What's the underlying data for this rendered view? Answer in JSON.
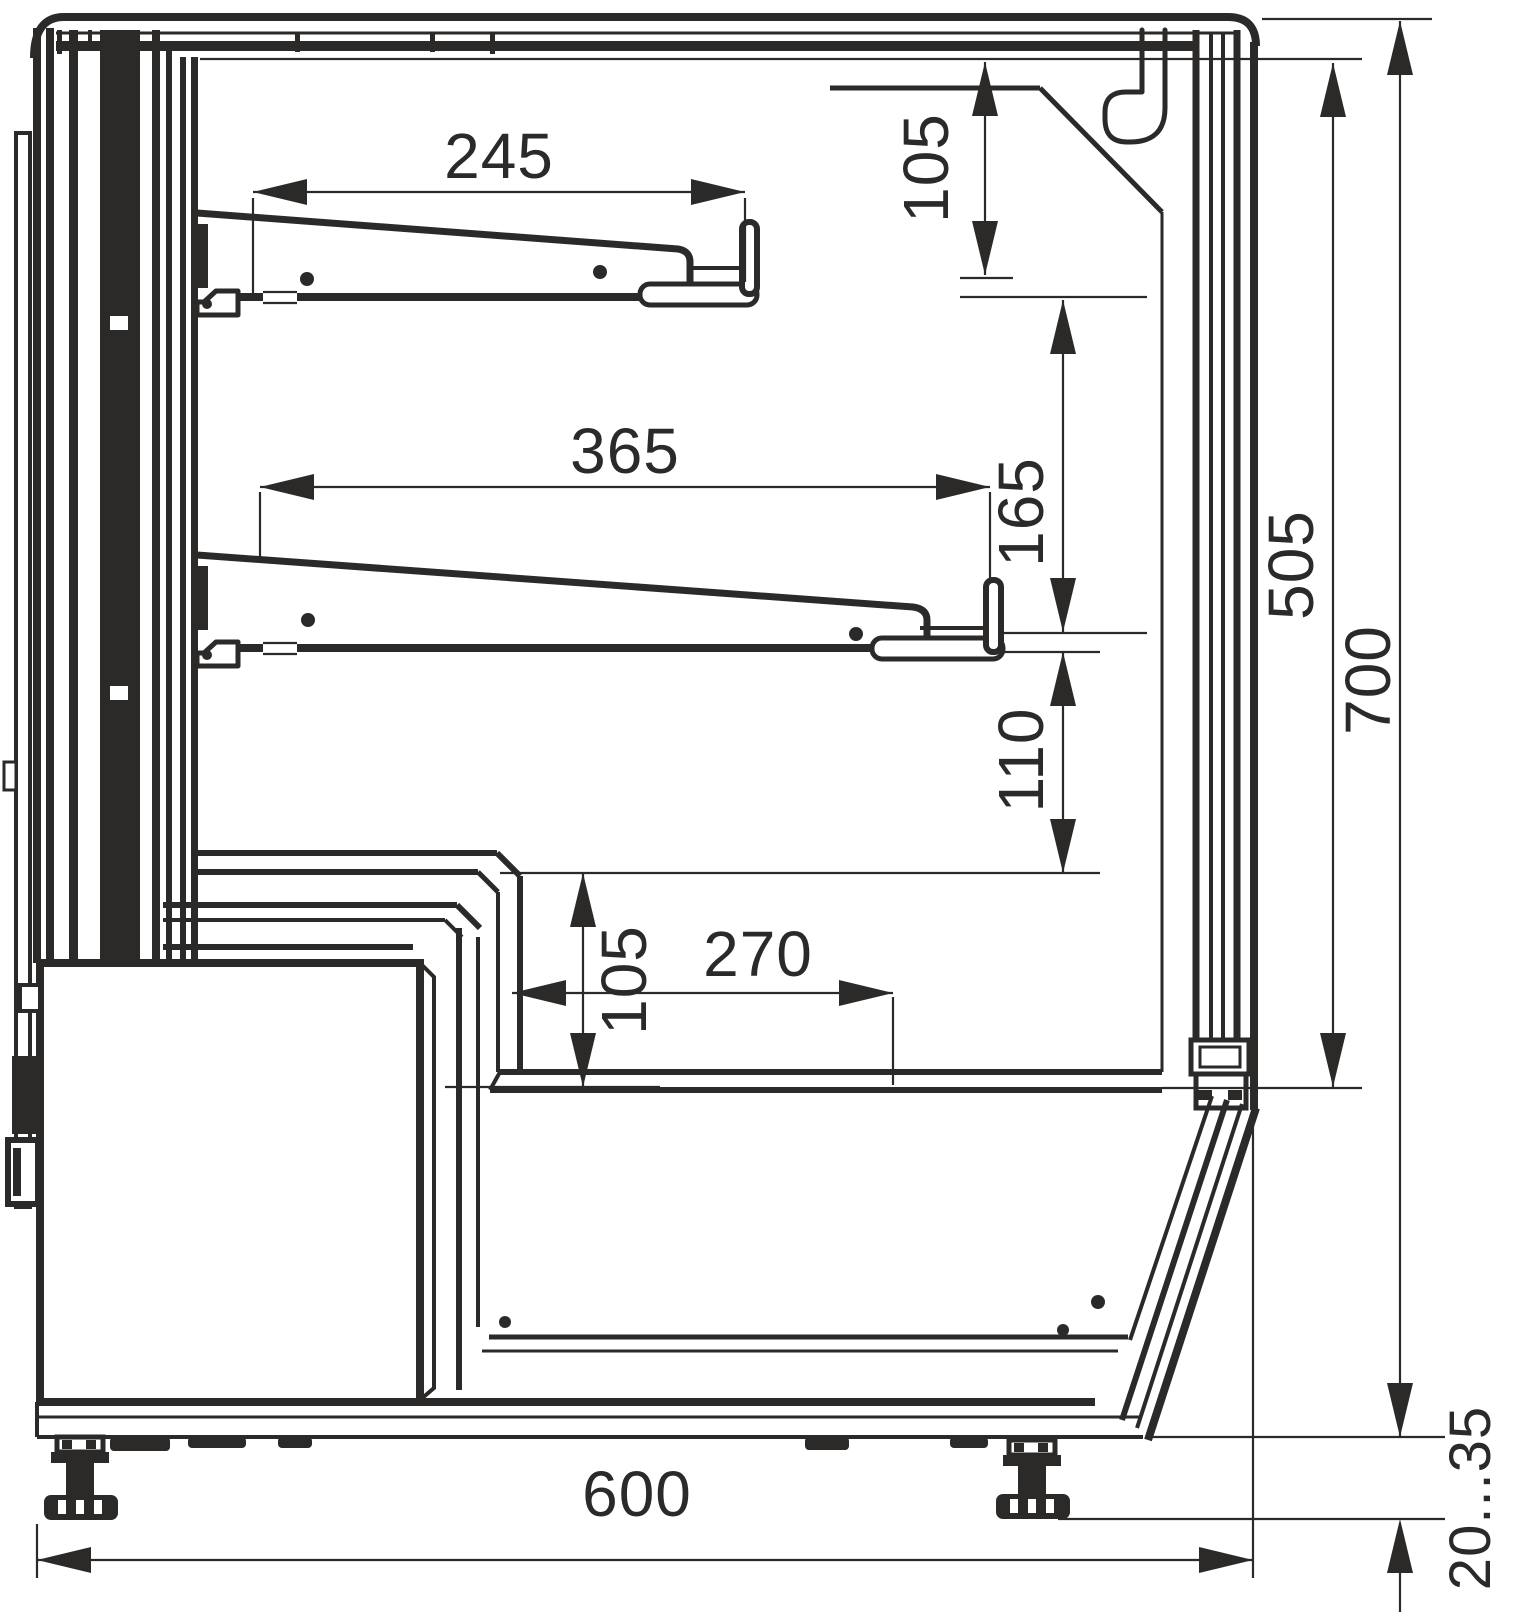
{
  "drawing": {
    "kind": "technical cross-section, side view of refrigerated display counter",
    "units": "mm",
    "colors": {
      "line": "#2b2a29",
      "background": "#ffffff"
    }
  },
  "dims": {
    "shelf_upper_depth": "245",
    "shelf_lower_depth": "365",
    "canopy_to_shelf": "105",
    "shelf_to_shelf": "165",
    "shelf_to_ledge": "110",
    "ledge_to_deck": "105",
    "deck_depth": "270",
    "inner_height": "505",
    "total_height": "700",
    "total_depth": "600",
    "foot_range": "20...35"
  }
}
